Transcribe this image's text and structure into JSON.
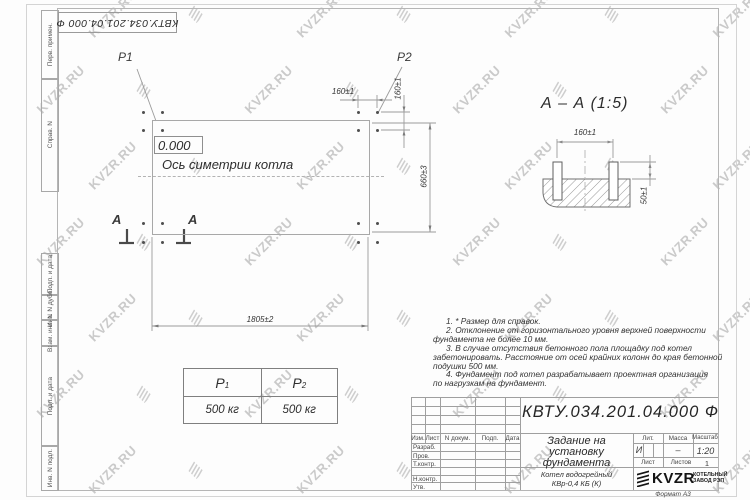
{
  "watermark": {
    "text": "KVZR.RU"
  },
  "corner_designation": "КВТУ.034.201.04.000  Ф",
  "sidebar": {
    "labels": [
      "Перв. примен.",
      "Справ. N",
      "Подп. и дата",
      "Инв. N дубл.",
      "Взам. инв. N",
      "Подп. и дата",
      "Инв. N подл."
    ]
  },
  "plan": {
    "p1": "P1",
    "p2": "P2",
    "level": "0.000",
    "axis_label": "Ось симетрии котла",
    "dim_top": "160±1",
    "dim_right_small": "160±1",
    "dim_right": "660±3",
    "dim_bottom": "1805±2",
    "section_letter_left": "А",
    "section_letter_right": "А"
  },
  "section": {
    "title": "А – А  (1:5)",
    "dim_width": "160±1",
    "dim_height": "50±1"
  },
  "load_table": {
    "col1": {
      "sym": "P",
      "sub": "1",
      "value": "500 кг"
    },
    "col2": {
      "sym": "P",
      "sub": "2",
      "value": "500 кг"
    }
  },
  "notes": {
    "lines": [
      "1. * Размер для справок.",
      "2. Отклонение от горизонтального уровня верхней поверхности",
      "фундамента не более 10 мм.",
      "3. В случае отсутствия бетонного пола площадку под котел",
      "забетонировать. Расстояние от осей крайних колонн до края бетонной",
      "подушки 500 мм.",
      "4. Фундамент под котел разрабатывает проектная организация",
      "по нагрузкам на фундамент."
    ]
  },
  "title_block": {
    "designation": "КВТУ.034.201.04.000  Ф",
    "title_lines": [
      "Задание на",
      "установку",
      "фундамента"
    ],
    "product_lines": [
      "Котел водогрейный",
      "КВр-0,4  КБ  (К)"
    ],
    "header_cols": {
      "izm": "Изм.",
      "list": "Лист",
      "doc": "N докум.",
      "podp": "Подп.",
      "date": "Дата"
    },
    "row_labels": [
      "Разраб.",
      "Пров.",
      "Т.контр.",
      "",
      "Н.контр.",
      "Утв."
    ],
    "lit_label": "Лит.",
    "mass_label": "Масса",
    "scale_label": "Масштаб",
    "lit_value": "И",
    "mass_value": "–",
    "scale_value": "1:20",
    "sheet_label": "Лист",
    "sheets_label": "Листов",
    "sheets_value": "1",
    "company": {
      "name": "KVZR",
      "line1": "КОТЕЛЬНЫЙ",
      "line2": "ЗАВОД РЭП"
    },
    "format": "Формат А3"
  }
}
